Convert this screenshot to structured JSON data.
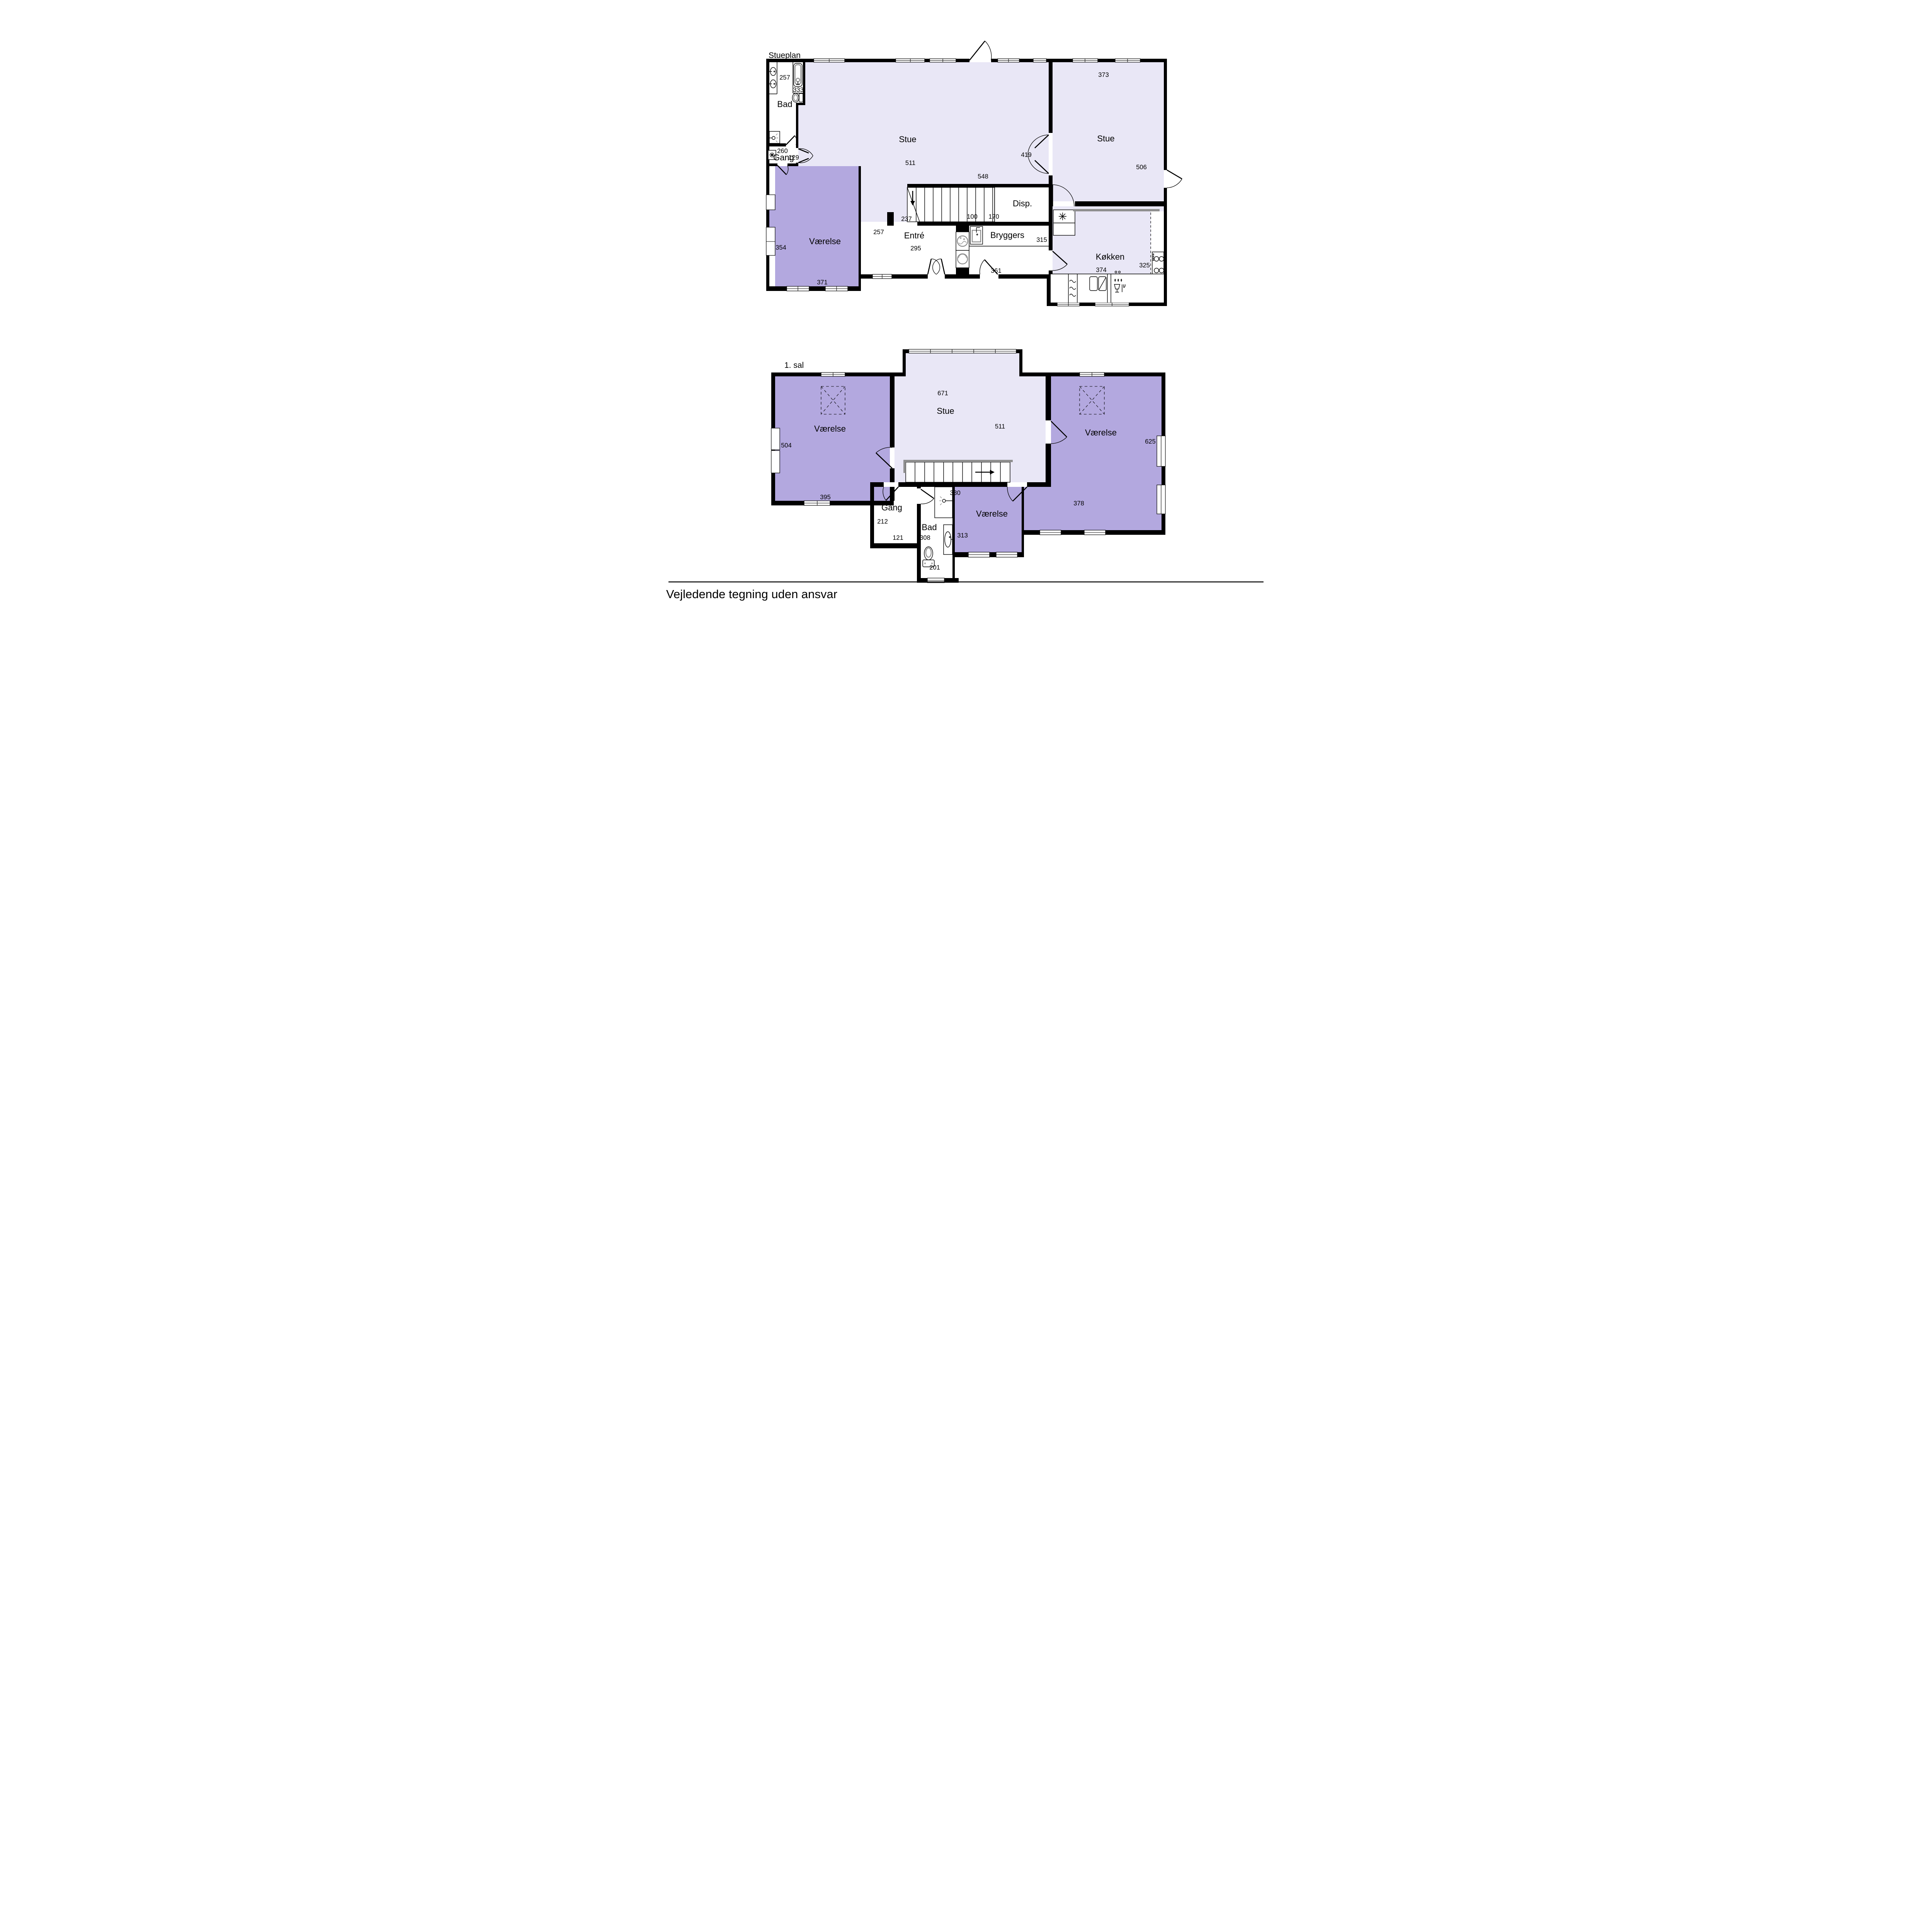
{
  "page": {
    "disclaimer": "Vejledende tegning uden ansvar"
  },
  "colors": {
    "wall": "#000000",
    "stue_fill": "#e9e7f6",
    "room_fill": "#b3a8df",
    "counter_gray": "#8f8f8f",
    "background": "#ffffff"
  },
  "ground_floor": {
    "title": "Stueplan",
    "rooms": {
      "bad": "Bad",
      "gang": "Gang",
      "stue_left": "Stue",
      "stue_right": "Stue",
      "disp": "Disp.",
      "vaerelse": "Værelse",
      "entre": "Entré",
      "bryggers": "Bryggers",
      "koekken": "Køkken"
    },
    "dims": {
      "bad_width": "257",
      "toilet_side": "333",
      "gang_width": "260",
      "gang_door": "129",
      "stue_height": "511",
      "passage": "237",
      "stairs_width": "548",
      "disp_a": "100",
      "disp_b": "170",
      "double_door": "419",
      "stue2_width": "373",
      "stue2_height": "506",
      "vaerelse_height": "354",
      "vaerelse_width": "371",
      "entre_height": "257",
      "entre_door": "295",
      "bryggers_door": "361",
      "bryggers_height": "315",
      "koekken_height": "325",
      "koekken_width": "374"
    }
  },
  "first_floor": {
    "title": "1. sal",
    "rooms": {
      "vaerelse_left": "Værelse",
      "stue": "Stue",
      "vaerelse_right": "Værelse",
      "gang": "Gang",
      "bad": "Bad",
      "vaerelse_mid": "Værelse"
    },
    "dims": {
      "stue_width": "671",
      "stue_height": "511",
      "vaerelse_left_height": "504",
      "vaerelse_left_width": "395",
      "vaerelse_right_height": "625",
      "vaerelse_right_width": "378",
      "gang_height": "212",
      "gang_width": "121",
      "bad_width": "308",
      "bad_door": "201",
      "vaerelse_mid_width": "330",
      "vaerelse_mid_height": "313"
    }
  }
}
